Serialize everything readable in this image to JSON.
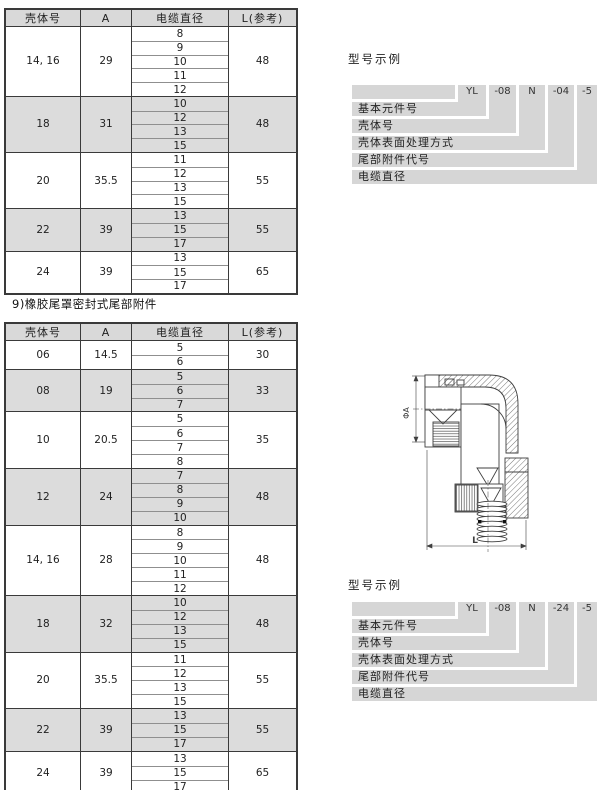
{
  "colors": {
    "header_bg": "#d9d9d9",
    "row_shade": "#dcdcdc",
    "stair_band": "#d6d6d6",
    "border_dark": "#3a3a3a",
    "border_light": "#8f8f8f"
  },
  "section": {
    "caption": "9)橡胶尾罩密封式尾部附件"
  },
  "table_top": {
    "headers": [
      "壳体号",
      "A",
      "电缆直径",
      "L(参考)"
    ],
    "groups": [
      {
        "shell": "14, 16",
        "a": "29",
        "diameters": [
          "8",
          "9",
          "10",
          "11",
          "12"
        ],
        "l": "48",
        "shaded": false
      },
      {
        "shell": "18",
        "a": "31",
        "diameters": [
          "10",
          "12",
          "13",
          "15"
        ],
        "l": "48",
        "shaded": true
      },
      {
        "shell": "20",
        "a": "35.5",
        "diameters": [
          "11",
          "12",
          "13",
          "15"
        ],
        "l": "55",
        "shaded": false
      },
      {
        "shell": "22",
        "a": "39",
        "diameters": [
          "13",
          "15",
          "17"
        ],
        "l": "55",
        "shaded": true
      },
      {
        "shell": "24",
        "a": "39",
        "diameters": [
          "13",
          "15",
          "17"
        ],
        "l": "65",
        "shaded": false
      }
    ]
  },
  "table_rubber_tail": {
    "headers": [
      "壳体号",
      "A",
      "电缆直径",
      "L(参考)"
    ],
    "groups": [
      {
        "shell": "06",
        "a": "14.5",
        "diameters": [
          "5",
          "6"
        ],
        "l": "30",
        "shaded": false
      },
      {
        "shell": "08",
        "a": "19",
        "diameters": [
          "5",
          "6",
          "7"
        ],
        "l": "33",
        "shaded": true
      },
      {
        "shell": "10",
        "a": "20.5",
        "diameters": [
          "5",
          "6",
          "7",
          "8"
        ],
        "l": "35",
        "shaded": false
      },
      {
        "shell": "12",
        "a": "24",
        "diameters": [
          "7",
          "8",
          "9",
          "10"
        ],
        "l": "48",
        "shaded": true
      },
      {
        "shell": "14, 16",
        "a": "28",
        "diameters": [
          "8",
          "9",
          "10",
          "11",
          "12"
        ],
        "l": "48",
        "shaded": false
      },
      {
        "shell": "18",
        "a": "32",
        "diameters": [
          "10",
          "12",
          "13",
          "15"
        ],
        "l": "48",
        "shaded": true
      },
      {
        "shell": "20",
        "a": "35.5",
        "diameters": [
          "11",
          "12",
          "13",
          "15"
        ],
        "l": "55",
        "shaded": false
      },
      {
        "shell": "22",
        "a": "39",
        "diameters": [
          "13",
          "15",
          "17"
        ],
        "l": "55",
        "shaded": true
      },
      {
        "shell": "24",
        "a": "39",
        "diameters": [
          "13",
          "15",
          "17"
        ],
        "l": "65",
        "shaded": false
      }
    ]
  },
  "model_examples": [
    {
      "title": "型号示例",
      "codes": [
        "YL",
        "-08",
        "N",
        "-04",
        "-5"
      ],
      "labels": [
        "基本元件号",
        "壳体号",
        "壳体表面处理方式",
        "尾部附件代号",
        "电缆直径"
      ]
    },
    {
      "title": "型号示例",
      "codes": [
        "YL",
        "-08",
        "N",
        "-24",
        "-5"
      ],
      "labels": [
        "基本元件号",
        "壳体号",
        "壳体表面处理方式",
        "尾部附件代号",
        "电缆直径"
      ]
    }
  ],
  "drawing": {
    "dim_vertical": "ΦA",
    "dim_horizontal": "L"
  }
}
